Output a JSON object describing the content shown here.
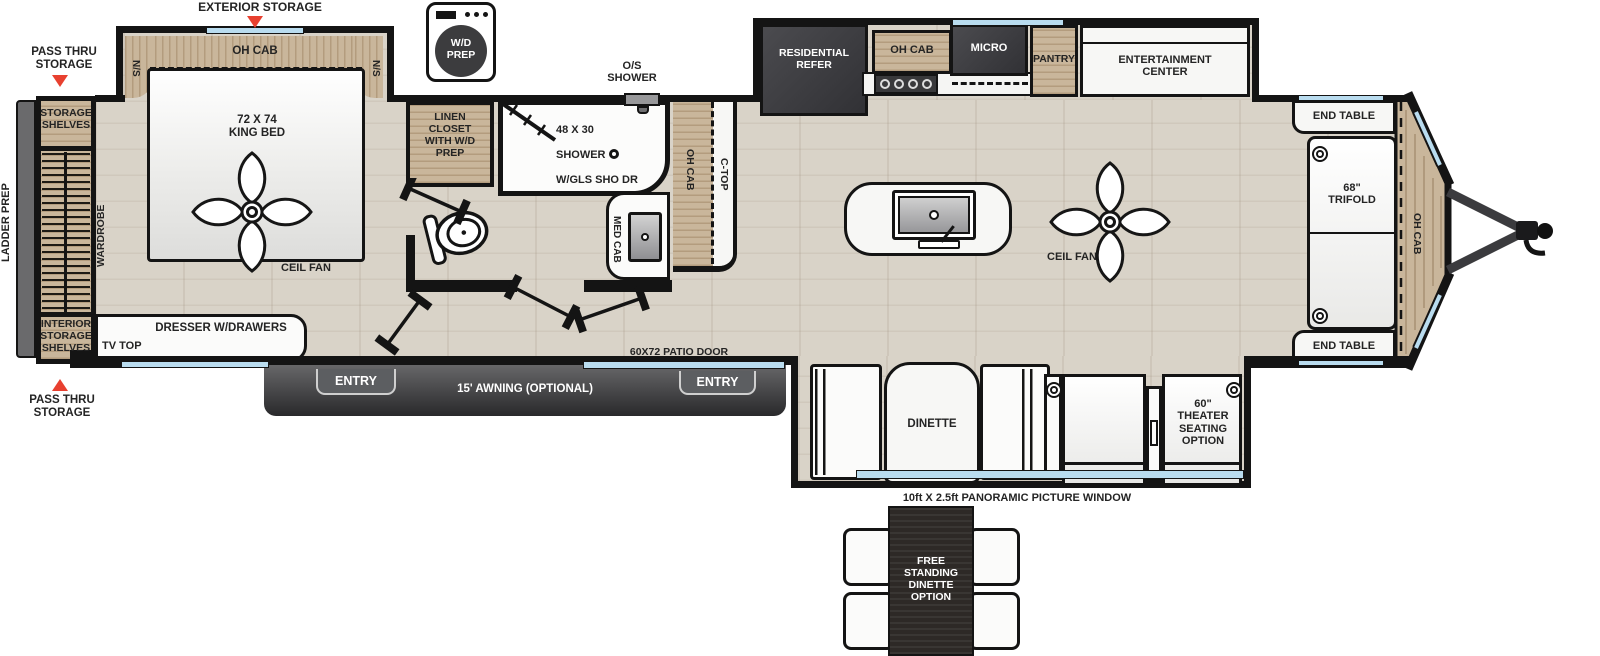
{
  "colors": {
    "wall": "#141414",
    "floor_wood": "#d9d3c8",
    "cabinet_wood": "#c9b69b",
    "appliance_dark": "#3e3e42",
    "window_blue": "#b9dcef",
    "arrow_red": "#e8402f",
    "awning_gray": "#3a3a3c",
    "marble_white": "#f7f7f5",
    "dinette_table_dark": "#2d2926"
  },
  "exterior": {
    "ladder_prep": "LADDER PREP",
    "exterior_storage": "EXTERIOR STORAGE",
    "pass_thru_top": "PASS THRU\nSTORAGE",
    "pass_thru_bottom": "PASS THRU\nSTORAGE",
    "os_shower": "O/S\nSHOWER",
    "awning": "15' AWNING (OPTIONAL)",
    "entry_rear": "ENTRY",
    "entry_front": "ENTRY",
    "patio_door": "60X72 PATIO DOOR",
    "panoramic_window": "10ft X 2.5ft PANORAMIC PICTURE WINDOW"
  },
  "bedroom": {
    "oh_cab": "OH CAB",
    "ns_left": "N/S",
    "ns_right": "N/S",
    "king_bed": "72 X 74\nKING BED",
    "ceil_fan": "CEIL FAN",
    "wardrobe": "WARDROBE",
    "storage_shelves": "STORAGE\nSHELVES",
    "interior_storage_shelves": "INTERIOR\nSTORAGE\nSHELVES",
    "dresser": "DRESSER W/DRAWERS",
    "tv_top": "TV TOP"
  },
  "bathroom": {
    "wd_prep": "W/D\nPREP",
    "linen_closet": "LINEN\nCLOSET\nWITH W/D\nPREP",
    "shower_size": "48 X 30",
    "shower": "SHOWER",
    "shower_door": "W/GLS SHO DR",
    "med_cab": "MED CAB"
  },
  "kitchen": {
    "refrigerator": "RESIDENTIAL\nREFER",
    "oh_cab": "OH CAB",
    "microwave": "MICRO",
    "pantry": "PANTRY",
    "entertainment_center": "ENTERTAINMENT\nCENTER",
    "oh_cab_counter": "OH CAB",
    "c_top": "C-TOP",
    "ceil_fan": "CEIL FAN"
  },
  "living": {
    "end_table_front": "END TABLE",
    "end_table_rear": "END TABLE",
    "trifold_sofa": "68\"\nTRIFOLD",
    "oh_cab_front": "OH CAB",
    "dinette": "DINETTE",
    "theater_seating": "60\"\nTHEATER\nSEATING\nOPTION"
  },
  "options": {
    "free_standing_dinette": "FREE\nSTANDING\nDINETTE\nOPTION"
  }
}
